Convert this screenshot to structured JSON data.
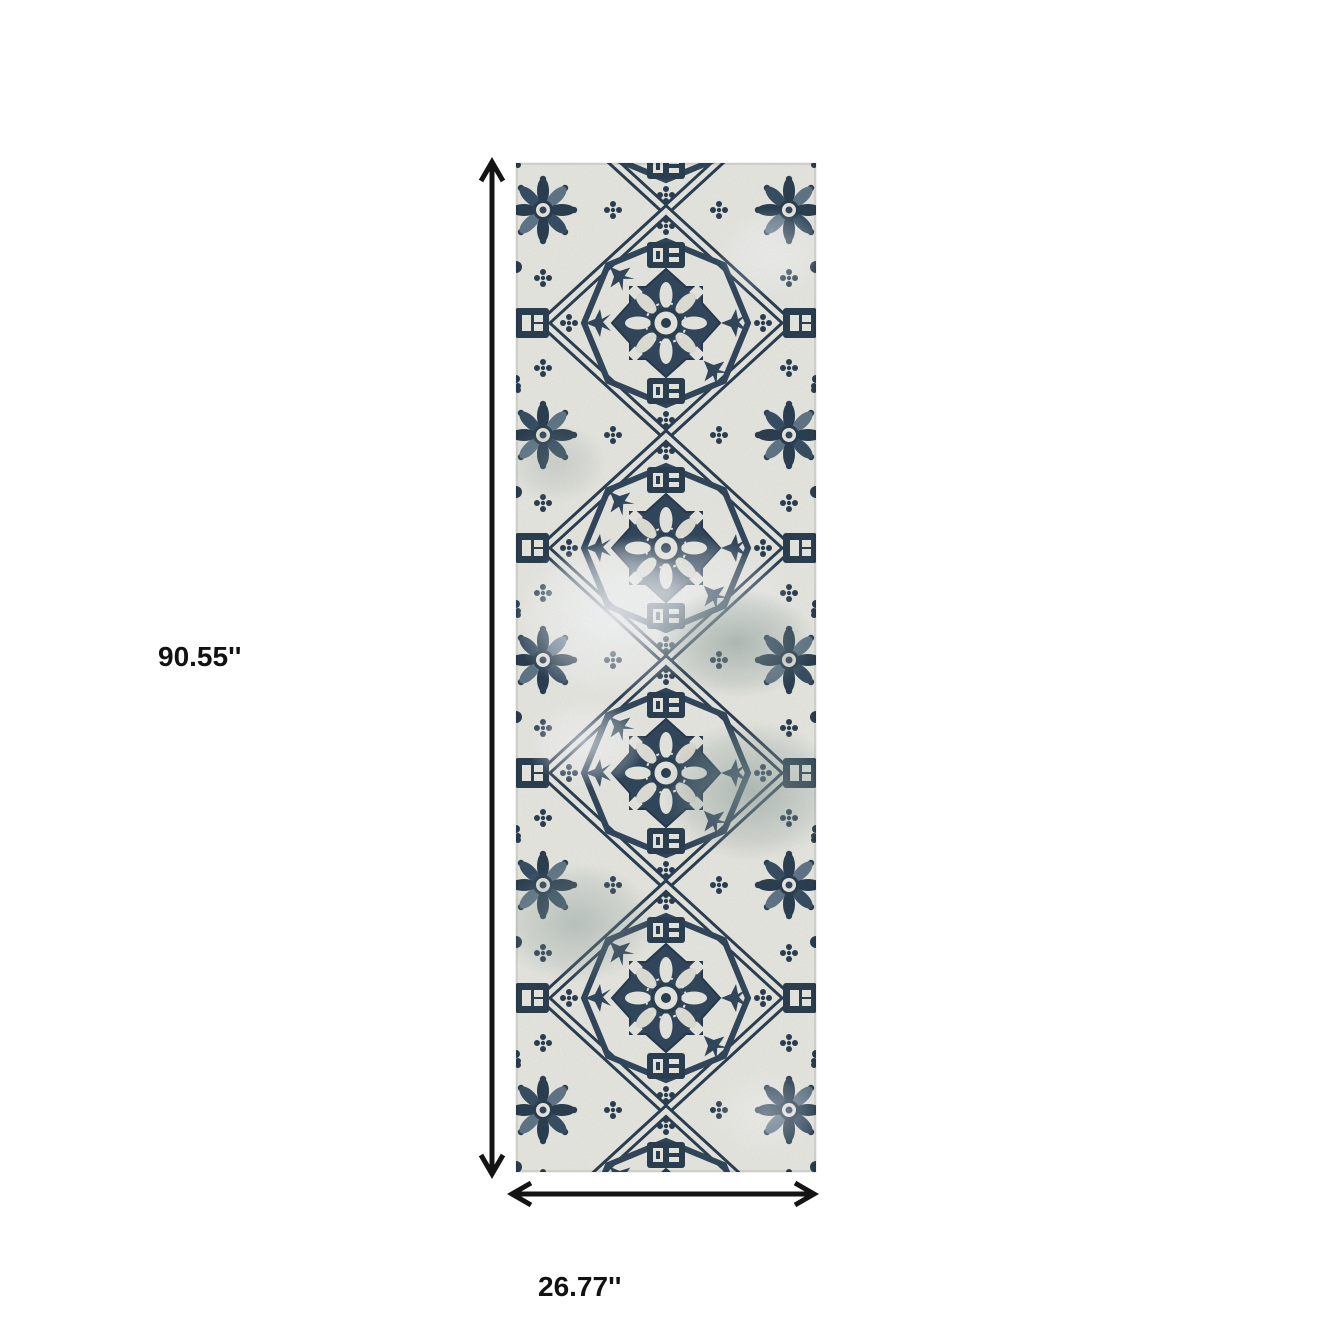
{
  "page": {
    "background_color": "#ffffff"
  },
  "diagram": {
    "type": "product-dimension-diagram",
    "product_description": "Navy blue and ivory distressed oriental medallion runner rug",
    "height_label": "90.55''",
    "width_label": "26.77''",
    "arrow_color": "#141414",
    "label_color": "#121212",
    "rug_palette": {
      "navy": "#24384a",
      "navy_light": "#32495e",
      "steel": "#5e7484",
      "ivory": "#f1efe6",
      "faded_sage": "#91a29b"
    }
  }
}
